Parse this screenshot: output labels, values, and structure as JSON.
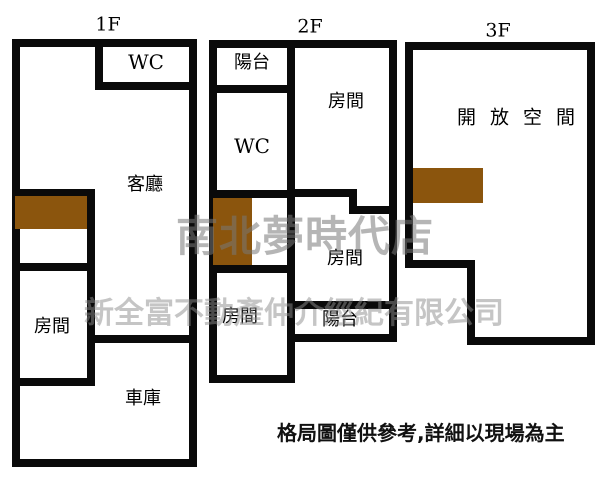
{
  "floors": [
    {
      "label": "1F",
      "rooms": {
        "wc": "WC",
        "living": "客廳",
        "bedroom": "房間",
        "garage": "車庫"
      }
    },
    {
      "label": "2F",
      "rooms": {
        "balcony_top": "陽台",
        "wc": "WC",
        "bedroom_top": "房間",
        "bedroom_mid": "房間",
        "bedroom_bottom": "房間",
        "balcony_bottom": "陽台"
      }
    },
    {
      "label": "3F",
      "rooms": {
        "open_space": "開放空間"
      }
    }
  ],
  "watermark": {
    "line1": "南北夢時代店",
    "line2": "新全富不動產仲介經紀有限公司"
  },
  "disclaimer": "格局圖僅供參考,詳細以現場為主",
  "colors": {
    "wall": "#0a0a0a",
    "stair_fill": "#8B550D",
    "watermark_line1": "#787878",
    "watermark_line2": "#8c8c8c",
    "background": "#ffffff"
  }
}
